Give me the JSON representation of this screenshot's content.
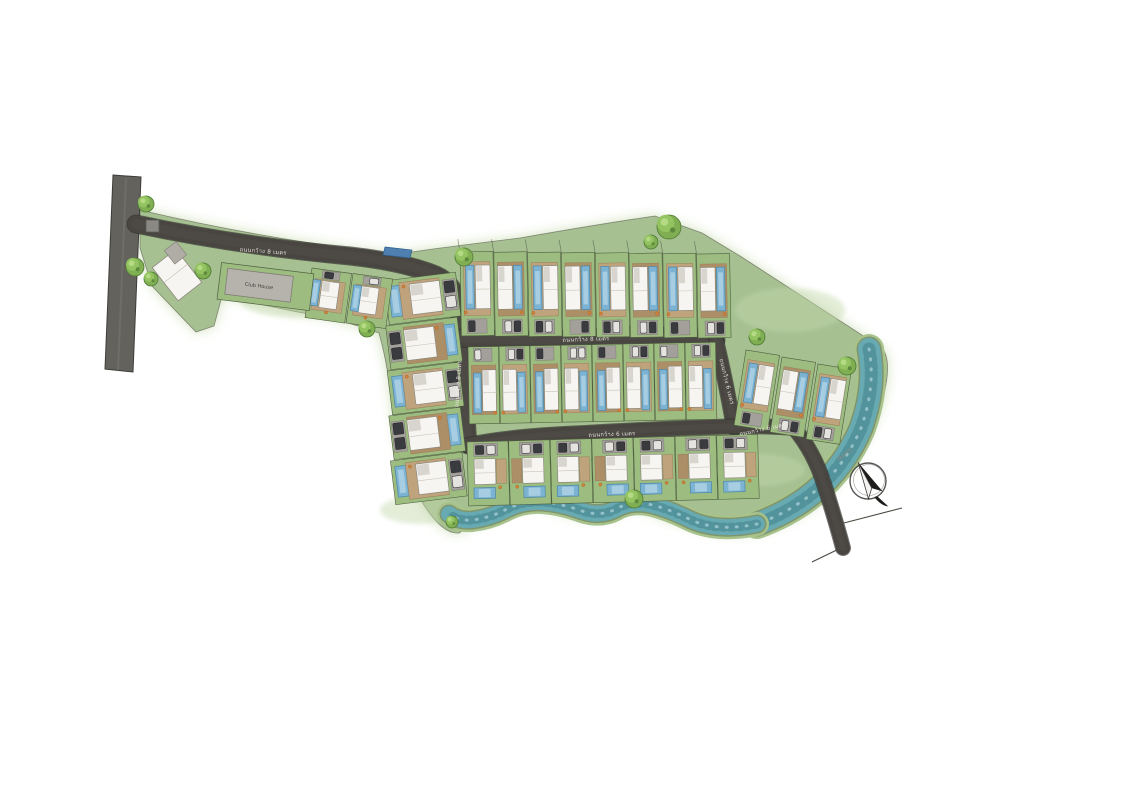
{
  "labels": {
    "club_house": "Club House",
    "north": "North",
    "road_8m": "ถนนกว้าง 8 เมตร",
    "road_6m": "ถนนกว้าง 6 เมตร"
  },
  "colors": {
    "page_bg": "#ffffff",
    "site_green": "#a6c092",
    "site_wash": "#cfe0b8",
    "plot_green": "#9dbd80",
    "plot_border": "#4f5e40",
    "road_dark": "#494642",
    "road_edge": "#2e2c29",
    "public_road": "#64625d",
    "stream_water": "#68aab2",
    "stream_deep": "#3f7f8a",
    "stream_bank": "#a8c28c",
    "pool_blue": "#7db3d2",
    "pool_edge": "#4c86a6",
    "villa_white": "#f7f5f1",
    "deck_tan": "#bfa37c",
    "drive_gray": "#a3a09b",
    "car_dark": "#3a3b3e",
    "car_light": "#e4e3df",
    "tree_green": "#7fae53",
    "sign_blue": "#4e7fb0",
    "label_text": "#ece9e2",
    "compass_ink": "#3a3936",
    "north_text": "#8b8b87"
  },
  "map": {
    "road_labels": [
      {
        "text_key": "road_8m",
        "x": 263,
        "y": 253,
        "rot": 4.5,
        "name": "entrance-road-label"
      },
      {
        "text_key": "road_8m",
        "x": 586,
        "y": 341,
        "rot": -2,
        "name": "middle-road-label"
      },
      {
        "text_key": "road_8m",
        "x": 460,
        "y": 384,
        "rot": -86,
        "name": "west-road-label"
      },
      {
        "text_key": "road_6m",
        "x": 612,
        "y": 436,
        "rot": -2,
        "name": "south-road-label"
      },
      {
        "text_key": "road_6m",
        "x": 725,
        "y": 382,
        "rot": 76,
        "name": "east-road-label"
      },
      {
        "text_key": "road_6m",
        "x": 763,
        "y": 431,
        "rot": -12,
        "name": "exit-road-label"
      }
    ],
    "clusters": [
      {
        "name": "north-villa-row",
        "count": 8,
        "x": 460,
        "y": 252,
        "dx": 33.8,
        "dy": 0.3,
        "w": 33,
        "h": 84,
        "rot": -1,
        "style": "drive-bottom",
        "ticks": true
      },
      {
        "name": "middle-villa-row",
        "count": 8,
        "x": 468,
        "y": 347,
        "dx": 31.0,
        "dy": -0.6,
        "w": 30.5,
        "h": 77,
        "rot": -1,
        "style": "drive-top"
      },
      {
        "name": "south-villa-row",
        "count": 7,
        "x": 467,
        "y": 442,
        "dx": 41.6,
        "dy": -1.1,
        "w": 41,
        "h": 64,
        "rot": -1.5,
        "style": "south"
      },
      {
        "name": "west-villa-column",
        "count": 5,
        "x": 384,
        "y": 281,
        "dx": 1.6,
        "dy": 45,
        "w": 72,
        "h": 44,
        "rot": -7,
        "style": "west",
        "col": true
      },
      {
        "name": "clubhouse-row",
        "count": 2,
        "x": 312,
        "y": 268,
        "dx": 41,
        "dy": 5.5,
        "w": 40,
        "h": 50,
        "rot": 8,
        "style": "club"
      },
      {
        "name": "east-villa-cluster",
        "count": 3,
        "x": 746,
        "y": 350,
        "dx": 36.0,
        "dy": 7,
        "w": 34,
        "h": 76,
        "rot": 9,
        "style": "drive-bottom"
      }
    ],
    "trees": [
      {
        "x": 146,
        "y": 204,
        "r": 8
      },
      {
        "x": 135,
        "y": 267,
        "r": 9
      },
      {
        "x": 151,
        "y": 279,
        "r": 7
      },
      {
        "x": 203,
        "y": 271,
        "r": 8
      },
      {
        "x": 367,
        "y": 329,
        "r": 8
      },
      {
        "x": 464,
        "y": 257,
        "r": 9
      },
      {
        "x": 651,
        "y": 242,
        "r": 7
      },
      {
        "x": 669,
        "y": 227,
        "r": 12
      },
      {
        "x": 757,
        "y": 337,
        "r": 8
      },
      {
        "x": 847,
        "y": 366,
        "r": 9
      },
      {
        "x": 634,
        "y": 499,
        "r": 9
      },
      {
        "x": 452,
        "y": 522,
        "r": 6
      }
    ],
    "compass": {
      "cx": 868,
      "cy": 481,
      "r": 18,
      "needle_rot": -28,
      "label_x": 846,
      "label_y": 456,
      "label_rot": -36
    },
    "clubhouse": {
      "cx": 265,
      "cy": 286,
      "rot": 7
    },
    "guardhouse": {
      "cx": 177,
      "cy": 275,
      "rot": -38
    }
  }
}
